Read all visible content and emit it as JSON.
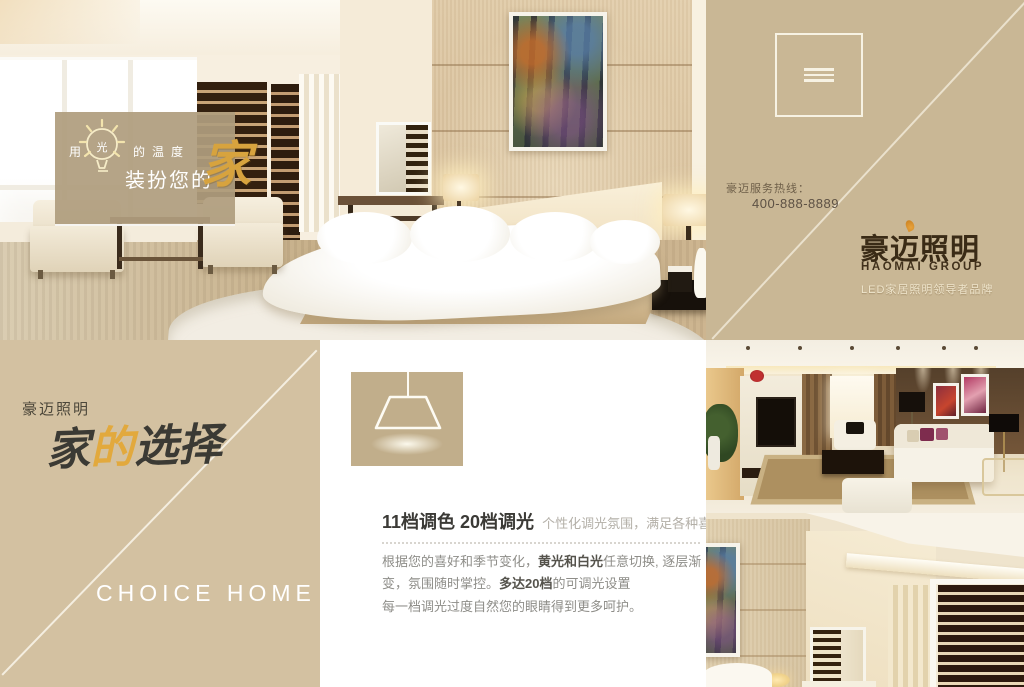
{
  "canvas": {
    "width": 1024,
    "height": 687
  },
  "colors": {
    "tan_panel": "#c9b795",
    "tan_panel_light": "#d3c1a1",
    "gold_accent": "#d7a33e",
    "logo_brown": "#3a2b16",
    "feature_bg": "#ffffff"
  },
  "hero_overlay": {
    "prefix": "用",
    "bulb_char": "光",
    "suffix": "的温度",
    "line2": "装扮您的",
    "calligraphy_home": "家",
    "bulb_icon": "lightbulb-icon"
  },
  "brand_panel": {
    "menu_icon": "hamburger-menu-icon",
    "hotline_label": "豪迈服务热线：",
    "hotline_number": "400-888-8889",
    "logo_cn": "豪迈照明",
    "logo_en": "HAOMAI GROUP",
    "tagline": "LED家居照明领导者品牌"
  },
  "choice_panel": {
    "brand": "豪迈照明",
    "calligraphy": {
      "char1": "家",
      "char2": "的",
      "char3": "选择"
    },
    "english_title": "CHOICE HOME"
  },
  "feature_panel": {
    "lamp_icon": "pendant-lamp-icon",
    "title": "11档调色 20档调光",
    "subtitle": "个性化调光氛围，满足各种喜好",
    "paragraph1": {
      "seg1": "根据您的喜好和季节变化，",
      "bold1": "黄光和白光",
      "seg2": "任意切换, 逐层渐变，氛围随时掌控。",
      "bold2": "多达20档",
      "seg3": "的可调光设置"
    },
    "paragraph2": "每一档调光过度自然您的眼睛得到更多呵护。"
  }
}
